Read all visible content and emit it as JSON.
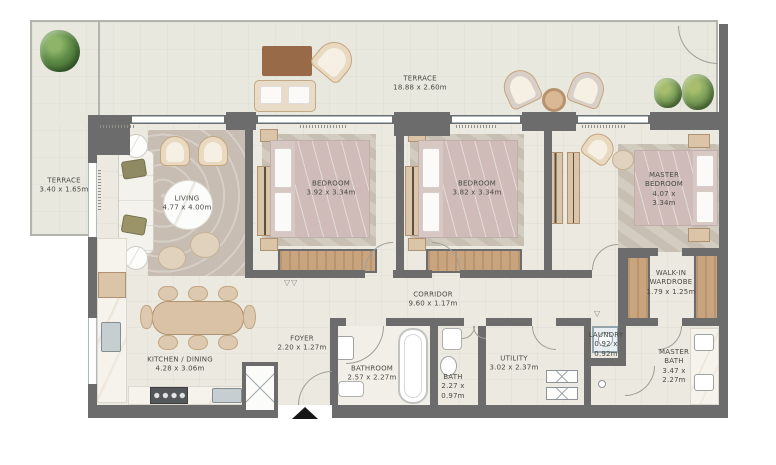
{
  "plan": {
    "type": "apartment-floor-plan",
    "rooms": [
      {
        "id": "terrace-left",
        "name": "TERRACE",
        "dims": "3.40 x 1.65m"
      },
      {
        "id": "terrace-top",
        "name": "TERRACE",
        "dims": "18.88 x 2.60m"
      },
      {
        "id": "living",
        "name": "LIVING",
        "dims": "4.77 x 4.00m"
      },
      {
        "id": "bedroom-1",
        "name": "BEDROOM",
        "dims": "3.92 x 3.34m"
      },
      {
        "id": "bedroom-2",
        "name": "BEDROOM",
        "dims": "3.82 x 3.34m"
      },
      {
        "id": "master-bedroom",
        "name": "MASTER BEDROOM",
        "dims": "4.07 x 3.34m"
      },
      {
        "id": "walk-in-wardrobe",
        "name": "WALK-IN WARDROBE",
        "dims": "1.79 x 1.25m"
      },
      {
        "id": "corridor",
        "name": "CORRIDOR",
        "dims": "9.60 x 1.17m"
      },
      {
        "id": "foyer",
        "name": "FOYER",
        "dims": "2.20 x 1.27m"
      },
      {
        "id": "kitchen-dining",
        "name": "KITCHEN / DINING",
        "dims": "4.28 x 3.06m"
      },
      {
        "id": "bathroom",
        "name": "BATHROOM",
        "dims": "2.57 x 2.27m"
      },
      {
        "id": "bath",
        "name": "BATH",
        "dims": "2.27 x 0.97m"
      },
      {
        "id": "utility",
        "name": "UTILITY",
        "dims": "3.02 x 2.37m"
      },
      {
        "id": "laundry",
        "name": "LAUNDRY",
        "dims": "0.92 x 0.92m"
      },
      {
        "id": "master-bath",
        "name": "MASTER BATH",
        "dims": "3.47 x 2.27m"
      }
    ],
    "colors": {
      "background": "#ffffff",
      "wall": "#6c6c6c",
      "floor": "#ebe9e0",
      "terrace_floor": "#e9e8df",
      "balustrade": "#b3b3ad",
      "wood": "#c9a57f",
      "rug": "#c7bdb2",
      "bed_linen": "#d8c8c4",
      "plant_green": "#4e7c3c",
      "label_text": "#4a4a44"
    }
  }
}
